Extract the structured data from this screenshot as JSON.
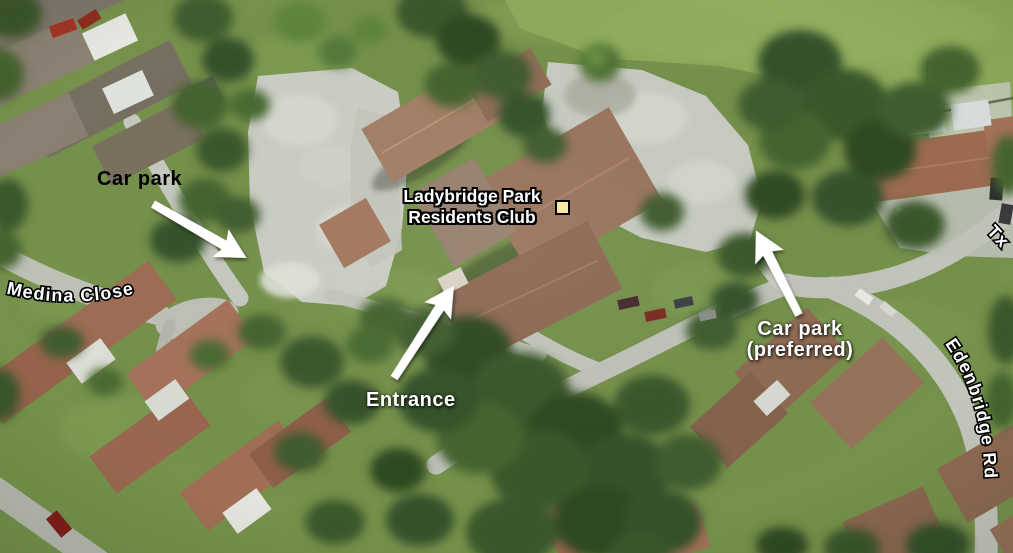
{
  "map": {
    "poi": {
      "name_line1": "Ladybridge Park",
      "name_line2": "Residents Club"
    },
    "annotations": {
      "car_park": "Car park",
      "entrance": "Entrance",
      "car_park_preferred_line1": "Car park",
      "car_park_preferred_line2": "(preferred)"
    },
    "streets": {
      "medina_close": "Medina Close",
      "edenbridge_rd": "Edenbridge Rd",
      "partial_street": "Tx"
    },
    "colors": {
      "car_park_label": "#000000",
      "white_labels": "#ffffff",
      "street_label_fill": "#ffffff",
      "street_label_outline": "#000000",
      "marker_fill": "#fbe7a6",
      "marker_border": "#000000",
      "arrow": "#ffffff"
    }
  }
}
